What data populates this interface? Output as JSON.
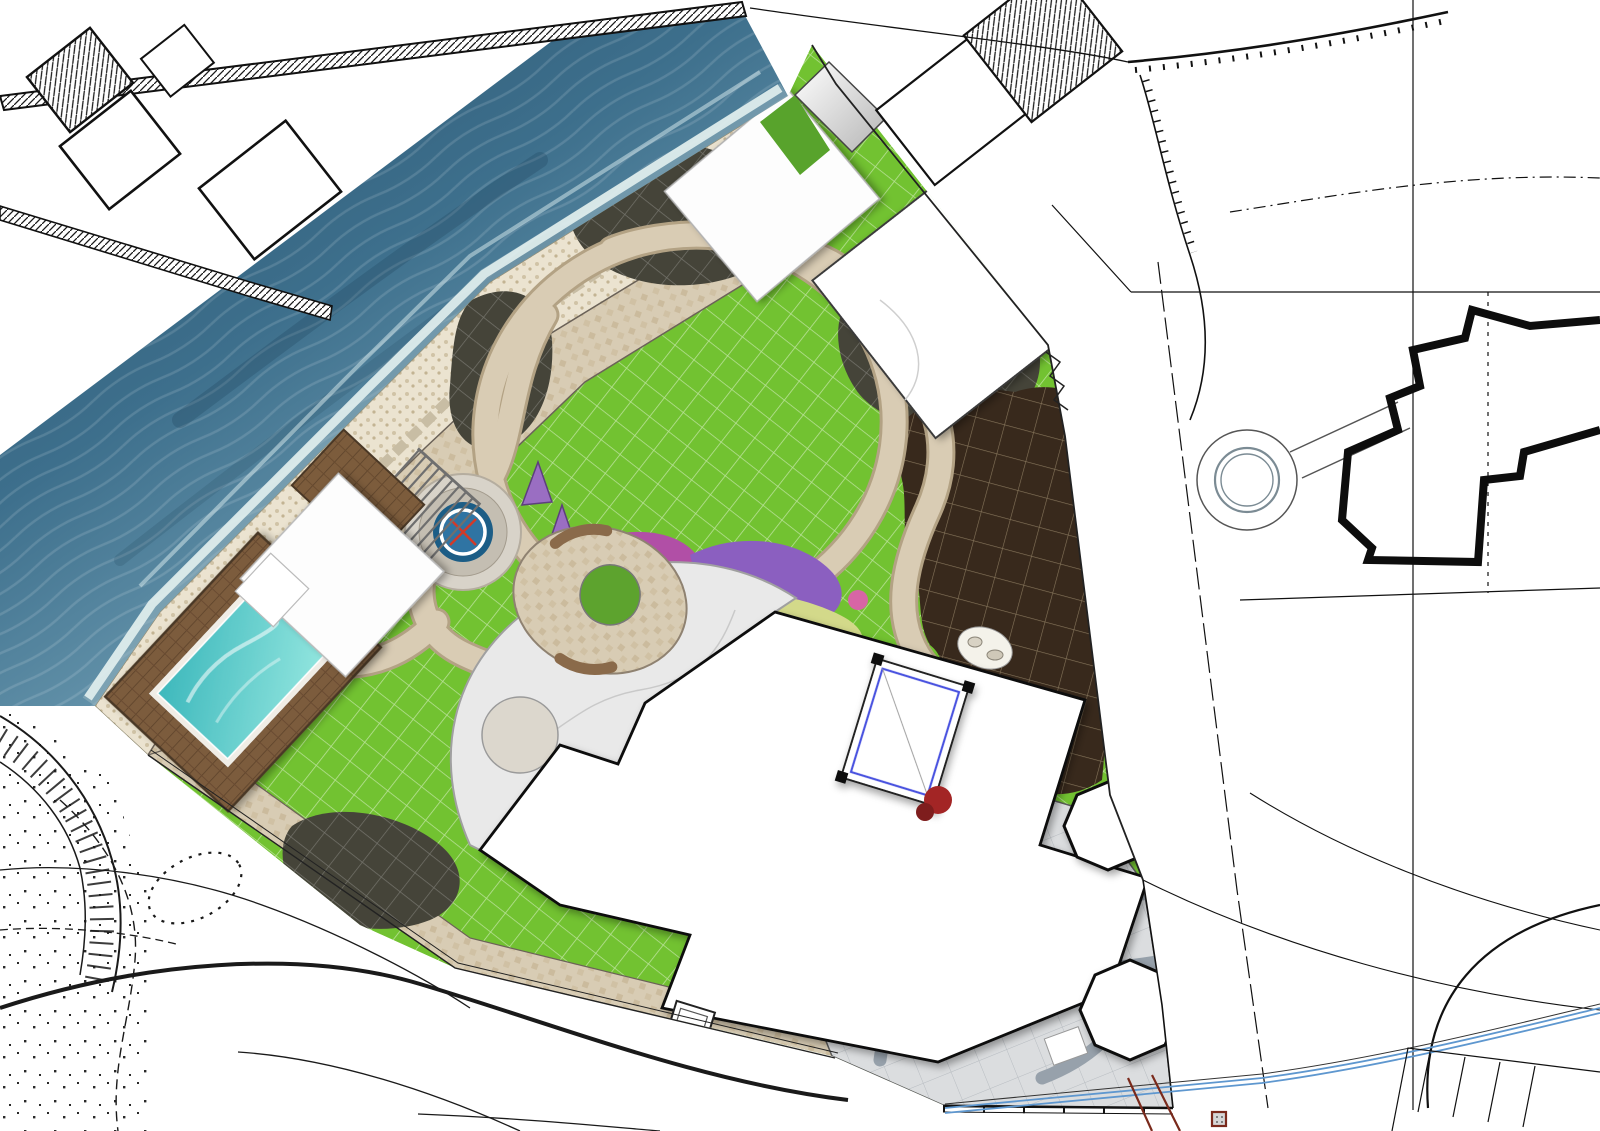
{
  "map_type": "landscape-master-plan-over-topographic-survey",
  "colors": {
    "sea_dark": "#29506b",
    "sea_light": "#9dbecb",
    "lawn": "#72c231",
    "mulch_bed": "#454439",
    "orchard_soil": "#38291c",
    "stone_path": "#d8ccb4",
    "pebble_beach": "#ebe3d0",
    "plaza": "#dbdddf",
    "pool_water": "#3db8bc",
    "deck_wood": "#7c5c3c",
    "accent_blue": "#4a52e0",
    "sight_line_red": "#e04030",
    "stream_blue": "#5e97cf",
    "survey_ink": "#0d0d0d"
  },
  "labels": {
    "black": [
      [
        "79",
        8,
        52,
        -40,
        0
      ],
      [
        "53.80",
        88,
        42,
        0,
        0
      ],
      [
        "52.42",
        35,
        100,
        -12,
        0
      ],
      [
        "52.38",
        112,
        76,
        -38,
        0
      ],
      [
        "52.16",
        180,
        128,
        0,
        0
      ],
      [
        "62",
        10,
        190,
        0,
        0
      ],
      [
        "52.12",
        78,
        190,
        0,
        0
      ],
      [
        "причал",
        150,
        192,
        -37,
        22
      ],
      [
        "52.11",
        322,
        12,
        0,
        0
      ],
      [
        "пр",
        370,
        14,
        -30,
        22
      ],
      [
        "52.08",
        878,
        40,
        -52,
        0
      ],
      [
        "53,72",
        995,
        18,
        0,
        34
      ],
      [
        "52.91",
        1007,
        47,
        0,
        0
      ],
      [
        "52.9",
        962,
        107,
        0,
        0
      ],
      [
        "53,67",
        1024,
        110,
        0,
        0
      ],
      [
        "53.",
        1038,
        135,
        0,
        0
      ],
      [
        "41",
        957,
        172,
        0,
        17
      ],
      [
        "53,9",
        1117,
        8,
        0,
        0
      ],
      [
        "54,09",
        1186,
        60,
        0,
        0
      ],
      [
        "53,95",
        1247,
        73,
        0,
        0
      ],
      [
        "53,53",
        1311,
        73,
        0,
        0
      ],
      [
        "54,14",
        1258,
        36,
        0,
        0
      ],
      [
        "54,27",
        1320,
        13,
        0,
        0
      ],
      [
        "53,83",
        1398,
        13,
        0,
        0
      ],
      [
        "53,63",
        1373,
        53,
        0,
        0
      ],
      [
        "53,86",
        1520,
        38,
        0,
        0
      ],
      [
        "53,51",
        1203,
        112,
        0,
        0
      ],
      [
        "53,44",
        1288,
        112,
        0,
        0
      ],
      [
        "53,18",
        1400,
        103,
        0,
        0
      ],
      [
        "53,18",
        1290,
        157,
        0,
        0
      ],
      [
        "53,19",
        1120,
        157,
        0,
        0
      ],
      [
        "53,66",
        1162,
        168,
        0,
        0
      ],
      [
        "53,23",
        1180,
        213,
        0,
        0
      ],
      [
        "53,61",
        1235,
        203,
        0,
        0
      ],
      [
        "53,30",
        1478,
        203,
        0,
        0
      ],
      [
        "53,15",
        1303,
        261,
        0,
        0
      ],
      [
        "53,47",
        1565,
        250,
        0,
        0
      ],
      [
        "53,08",
        1105,
        246,
        0,
        0
      ],
      [
        "53,57",
        1093,
        271,
        0,
        0
      ],
      [
        "53,22",
        1188,
        330,
        0,
        0
      ],
      [
        "53,43",
        1400,
        333,
        0,
        0
      ],
      [
        "53,30",
        1255,
        392,
        0,
        0
      ],
      [
        "53,42",
        1342,
        528,
        0,
        0
      ],
      [
        "53,38",
        1556,
        440,
        0,
        0
      ],
      [
        "53,46",
        1530,
        652,
        0,
        0
      ],
      [
        "53,39",
        1213,
        688,
        0,
        0
      ],
      [
        "53,43",
        1368,
        882,
        0,
        0
      ],
      [
        "53,38",
        1162,
        920,
        0,
        0
      ],
      [
        "53",
        1592,
        188,
        0,
        0
      ],
      [
        "53,91",
        128,
        853,
        0,
        0
      ],
      [
        "53,97",
        143,
        915,
        0,
        0
      ],
      [
        "53,38",
        225,
        898,
        0,
        0
      ],
      [
        "54,03",
        248,
        966,
        0,
        0
      ],
      [
        "53.81",
        285,
        1028,
        0,
        0
      ],
      [
        "53,78",
        368,
        965,
        0,
        0
      ],
      [
        "53,63",
        375,
        1008,
        0,
        0
      ],
      [
        "53.50",
        372,
        1042,
        -38,
        0
      ],
      [
        "53,50",
        475,
        990,
        0,
        0
      ],
      [
        "53,22",
        480,
        1058,
        0,
        0
      ],
      [
        "53.07",
        478,
        1102,
        -8,
        0
      ],
      [
        "53,44",
        634,
        1020,
        0,
        0
      ],
      [
        "53,16",
        612,
        1085,
        0,
        0
      ],
      [
        "53,16",
        690,
        1120,
        0,
        0
      ],
      [
        "53,33",
        756,
        1055,
        0,
        0
      ],
      [
        "53,47",
        868,
        1048,
        0,
        0
      ],
      [
        "53,34",
        864,
        1099,
        0,
        0
      ],
      [
        "53,27",
        772,
        1122,
        0,
        0
      ],
      [
        "53,47",
        1190,
        1117,
        0,
        0
      ],
      [
        "53,39",
        1315,
        1098,
        0,
        0
      ]
    ],
    "gray": [
      [
        "53,17",
        858,
        657,
        0,
        0,
        ""
      ],
      [
        "53,56",
        632,
        770,
        0,
        0,
        ""
      ],
      [
        "53,03",
        762,
        784,
        0,
        0,
        ""
      ],
      [
        "53,31",
        588,
        864,
        0,
        0,
        ""
      ],
      [
        "53,25",
        714,
        899,
        0,
        0,
        ""
      ],
      [
        "52,95",
        833,
        882,
        0,
        0,
        ""
      ],
      [
        "52,97",
        898,
        964,
        0,
        0,
        ""
      ],
      [
        "53,23",
        950,
        918,
        0,
        0,
        ""
      ],
      [
        "53,30",
        1060,
        966,
        0,
        0,
        ""
      ],
      [
        "53,46",
        882,
        1024,
        0,
        0,
        ""
      ],
      [
        "53,48",
        975,
        1088,
        0,
        0,
        ""
      ],
      [
        "53.",
        912,
        240,
        0,
        0,
        ""
      ],
      [
        "53,45",
        952,
        242,
        0,
        0,
        ""
      ],
      [
        "51,20",
        142,
        500,
        -35,
        0,
        "strike"
      ],
      [
        "53,11",
        155,
        527,
        -35,
        0,
        "box"
      ],
      [
        "53,05",
        282,
        600,
        -35,
        0,
        "faint"
      ],
      [
        "52,80",
        425,
        782,
        0,
        24,
        "faint"
      ],
      [
        "52",
        55,
        668,
        0,
        24,
        "faint"
      ],
      [
        "53,46",
        722,
        380,
        -15,
        0,
        "faint"
      ],
      [
        "53,41",
        742,
        404,
        -15,
        0,
        "faint"
      ],
      [
        "53,46",
        155,
        737,
        -12,
        0,
        ""
      ]
    ],
    "hand": [
      [
        "2",
        985,
        205,
        -10,
        58
      ],
      [
        "23",
        1040,
        198,
        -8,
        46
      ],
      [
        "12",
        1122,
        238,
        -62,
        38
      ],
      [
        "16",
        1490,
        560,
        8,
        42
      ],
      [
        "17",
        1302,
        600,
        22,
        42
      ],
      [
        "14",
        942,
        1140,
        0,
        36
      ],
      [
        "49",
        1292,
        1140,
        0,
        36
      ],
      [
        "2",
        795,
        990,
        12,
        38
      ]
    ]
  },
  "decor": {
    "markers": [
      [
        1137,
        62
      ],
      [
        1180,
        84
      ],
      [
        1219,
        82
      ],
      [
        1250,
        94
      ],
      [
        1318,
        25
      ],
      [
        1352,
        94
      ],
      [
        1480,
        24
      ],
      [
        1565,
        155
      ],
      [
        1428,
        190
      ],
      [
        1128,
        200
      ],
      [
        1268,
        252
      ],
      [
        1244,
        139
      ],
      [
        1204,
        322
      ],
      [
        1210,
        380
      ],
      [
        1304,
        520
      ],
      [
        1526,
        440
      ],
      [
        1491,
        642
      ],
      [
        1273,
        680
      ],
      [
        1396,
        860
      ],
      [
        118,
        864
      ],
      [
        188,
        911
      ],
      [
        336,
        996
      ],
      [
        442,
        1048
      ],
      [
        571,
        1078
      ],
      [
        683,
        1088
      ],
      [
        778,
        1098
      ],
      [
        1232,
        964
      ],
      [
        958,
        192
      ],
      [
        1065,
        227
      ],
      [
        1106,
        262
      ],
      [
        614,
        1006
      ],
      [
        838,
        1072
      ]
    ],
    "gray_markers": [
      [
        927,
        912
      ],
      [
        1040,
        958
      ],
      [
        940,
        1020
      ],
      [
        955,
        1078
      ],
      [
        800,
        867
      ],
      [
        660,
        890
      ],
      [
        848,
        700
      ],
      [
        955,
        737
      ],
      [
        700,
        898
      ],
      [
        622,
        858
      ],
      [
        905,
        878
      ],
      [
        680,
        965
      ],
      [
        345,
        923
      ]
    ],
    "dots": [
      [
        246,
        1022
      ],
      [
        715,
        1040
      ]
    ],
    "wells": [
      [
        1155,
        292,
        13
      ],
      [
        1488,
        292,
        13
      ],
      [
        1306,
        597,
        12
      ],
      [
        1488,
        593,
        12
      ],
      [
        943,
        1106,
        16
      ],
      [
        1173,
        1108,
        16
      ],
      [
        828,
        1030,
        14
      ],
      [
        362,
        938,
        12
      ],
      [
        1003,
        242,
        11
      ]
    ],
    "crosses": [
      [
        652,
        1052
      ]
    ],
    "arrow": [
      1427,
      246
    ],
    "flag_triangle": [
      1245,
      1092
    ],
    "goblet_trees": [
      [
        790,
        1032,
        -20
      ],
      [
        826,
        1090,
        15
      ],
      [
        872,
        1118,
        -10
      ],
      [
        918,
        1120,
        12
      ],
      [
        385,
        1043,
        -25
      ],
      [
        424,
        1092,
        14
      ],
      [
        508,
        1110,
        -8
      ],
      [
        610,
        1117,
        18
      ],
      [
        682,
        1127,
        0
      ],
      [
        1040,
        88,
        -38
      ],
      [
        1056,
        142,
        -38
      ],
      [
        1022,
        178,
        -38
      ]
    ],
    "vmarks": [
      [
        700,
        48
      ],
      [
        660,
        76
      ],
      [
        620,
        104
      ],
      [
        580,
        132
      ],
      [
        540,
        160
      ],
      [
        500,
        188
      ],
      [
        458,
        216
      ],
      [
        233,
        34
      ],
      [
        203,
        55
      ],
      [
        172,
        77
      ],
      [
        142,
        98
      ]
    ],
    "hedges": [
      {
        "from": [
          808,
          140
        ],
        "to": [
          1044,
          340
        ],
        "n": 13,
        "r": 12
      },
      {
        "from": [
          1050,
          362
        ],
        "to": [
          1102,
          788
        ],
        "n": 15,
        "r": 11
      }
    ],
    "blue_trees": [
      [
        556,
        300,
        14
      ],
      [
        524,
        254,
        11
      ],
      [
        608,
        192,
        12
      ],
      [
        806,
        220,
        15
      ],
      [
        832,
        250,
        12
      ],
      [
        906,
        334,
        15
      ],
      [
        942,
        372,
        13
      ],
      [
        1004,
        388,
        14
      ],
      [
        876,
        396,
        12
      ],
      [
        962,
        350,
        12
      ],
      [
        996,
        378,
        12
      ],
      [
        318,
        838,
        13
      ],
      [
        418,
        888,
        14
      ],
      [
        368,
        862,
        10
      ],
      [
        1062,
        730,
        11
      ],
      [
        1040,
        758,
        10
      ],
      [
        748,
        420,
        11
      ]
    ],
    "orchard_trees": [
      [
        932,
        448,
        15
      ],
      [
        976,
        462,
        16
      ],
      [
        1020,
        476,
        14
      ],
      [
        950,
        492,
        13
      ],
      [
        994,
        506,
        15
      ],
      [
        1038,
        522,
        14
      ],
      [
        926,
        536,
        13
      ],
      [
        970,
        552,
        16
      ],
      [
        1016,
        566,
        14
      ],
      [
        1056,
        582,
        13
      ],
      [
        946,
        598,
        14
      ],
      [
        990,
        612,
        15
      ],
      [
        1034,
        628,
        13
      ],
      [
        962,
        652,
        14
      ],
      [
        1006,
        666,
        15
      ],
      [
        1048,
        682,
        13
      ],
      [
        978,
        706,
        14
      ],
      [
        1020,
        720,
        14
      ],
      [
        992,
        744,
        12
      ]
    ],
    "green_trees": [
      [
        640,
        172,
        16
      ],
      [
        672,
        198,
        13
      ],
      [
        612,
        225,
        11
      ],
      [
        582,
        252,
        12
      ],
      [
        545,
        282,
        11
      ],
      [
        508,
        318,
        12
      ],
      [
        876,
        310,
        12
      ],
      [
        848,
        338,
        11
      ],
      [
        660,
        620,
        9
      ],
      [
        905,
        660,
        10
      ],
      [
        930,
        680,
        9
      ],
      [
        500,
        700,
        10
      ],
      [
        525,
        718,
        9
      ],
      [
        245,
        790,
        11
      ],
      [
        270,
        812,
        10
      ]
    ],
    "bushes": [
      [
        215,
        655
      ],
      [
        240,
        628
      ],
      [
        264,
        602
      ],
      [
        288,
        577
      ],
      [
        312,
        552
      ],
      [
        336,
        527
      ],
      [
        360,
        503
      ],
      [
        384,
        479
      ],
      [
        570,
        640
      ],
      [
        585,
        650
      ],
      [
        935,
        790
      ],
      [
        955,
        770
      ],
      [
        700,
        250
      ],
      [
        725,
        235
      ],
      [
        670,
        270
      ],
      [
        905,
        420
      ],
      [
        930,
        440
      ],
      [
        880,
        400
      ],
      [
        1010,
        712
      ],
      [
        1035,
        700
      ],
      [
        470,
        760
      ],
      [
        495,
        740
      ],
      [
        302,
        855
      ],
      [
        330,
        880
      ],
      [
        362,
        900
      ],
      [
        398,
        912
      ],
      [
        608,
        305
      ],
      [
        632,
        290
      ]
    ],
    "stepping_stones": [
      [
        505,
        435
      ],
      [
        524,
        452
      ],
      [
        543,
        470
      ],
      [
        561,
        488
      ],
      [
        579,
        505
      ],
      [
        640,
        558
      ],
      [
        666,
        570
      ],
      [
        695,
        580
      ],
      [
        724,
        589
      ],
      [
        753,
        597
      ],
      [
        782,
        606
      ],
      [
        810,
        616
      ],
      [
        838,
        628
      ]
    ],
    "white_squares": [
      [
        872,
        967
      ],
      [
        862,
        1012
      ],
      [
        953,
        1035
      ],
      [
        1053,
        1017
      ],
      [
        953,
        1075
      ],
      [
        1046,
        1096
      ],
      [
        1168,
        893
      ],
      [
        1162,
        962
      ]
    ],
    "blue_squares": [
      [
        427,
        520
      ],
      [
        447,
        494
      ],
      [
        783,
        168
      ]
    ],
    "red_lines": [
      [
        420,
        478,
        523,
        592
      ],
      [
        527,
        445,
        418,
        568
      ],
      [
        563,
        468,
        702,
        757
      ],
      [
        610,
        470,
        520,
        600
      ],
      [
        463,
        532,
        610,
        600
      ]
    ]
  }
}
